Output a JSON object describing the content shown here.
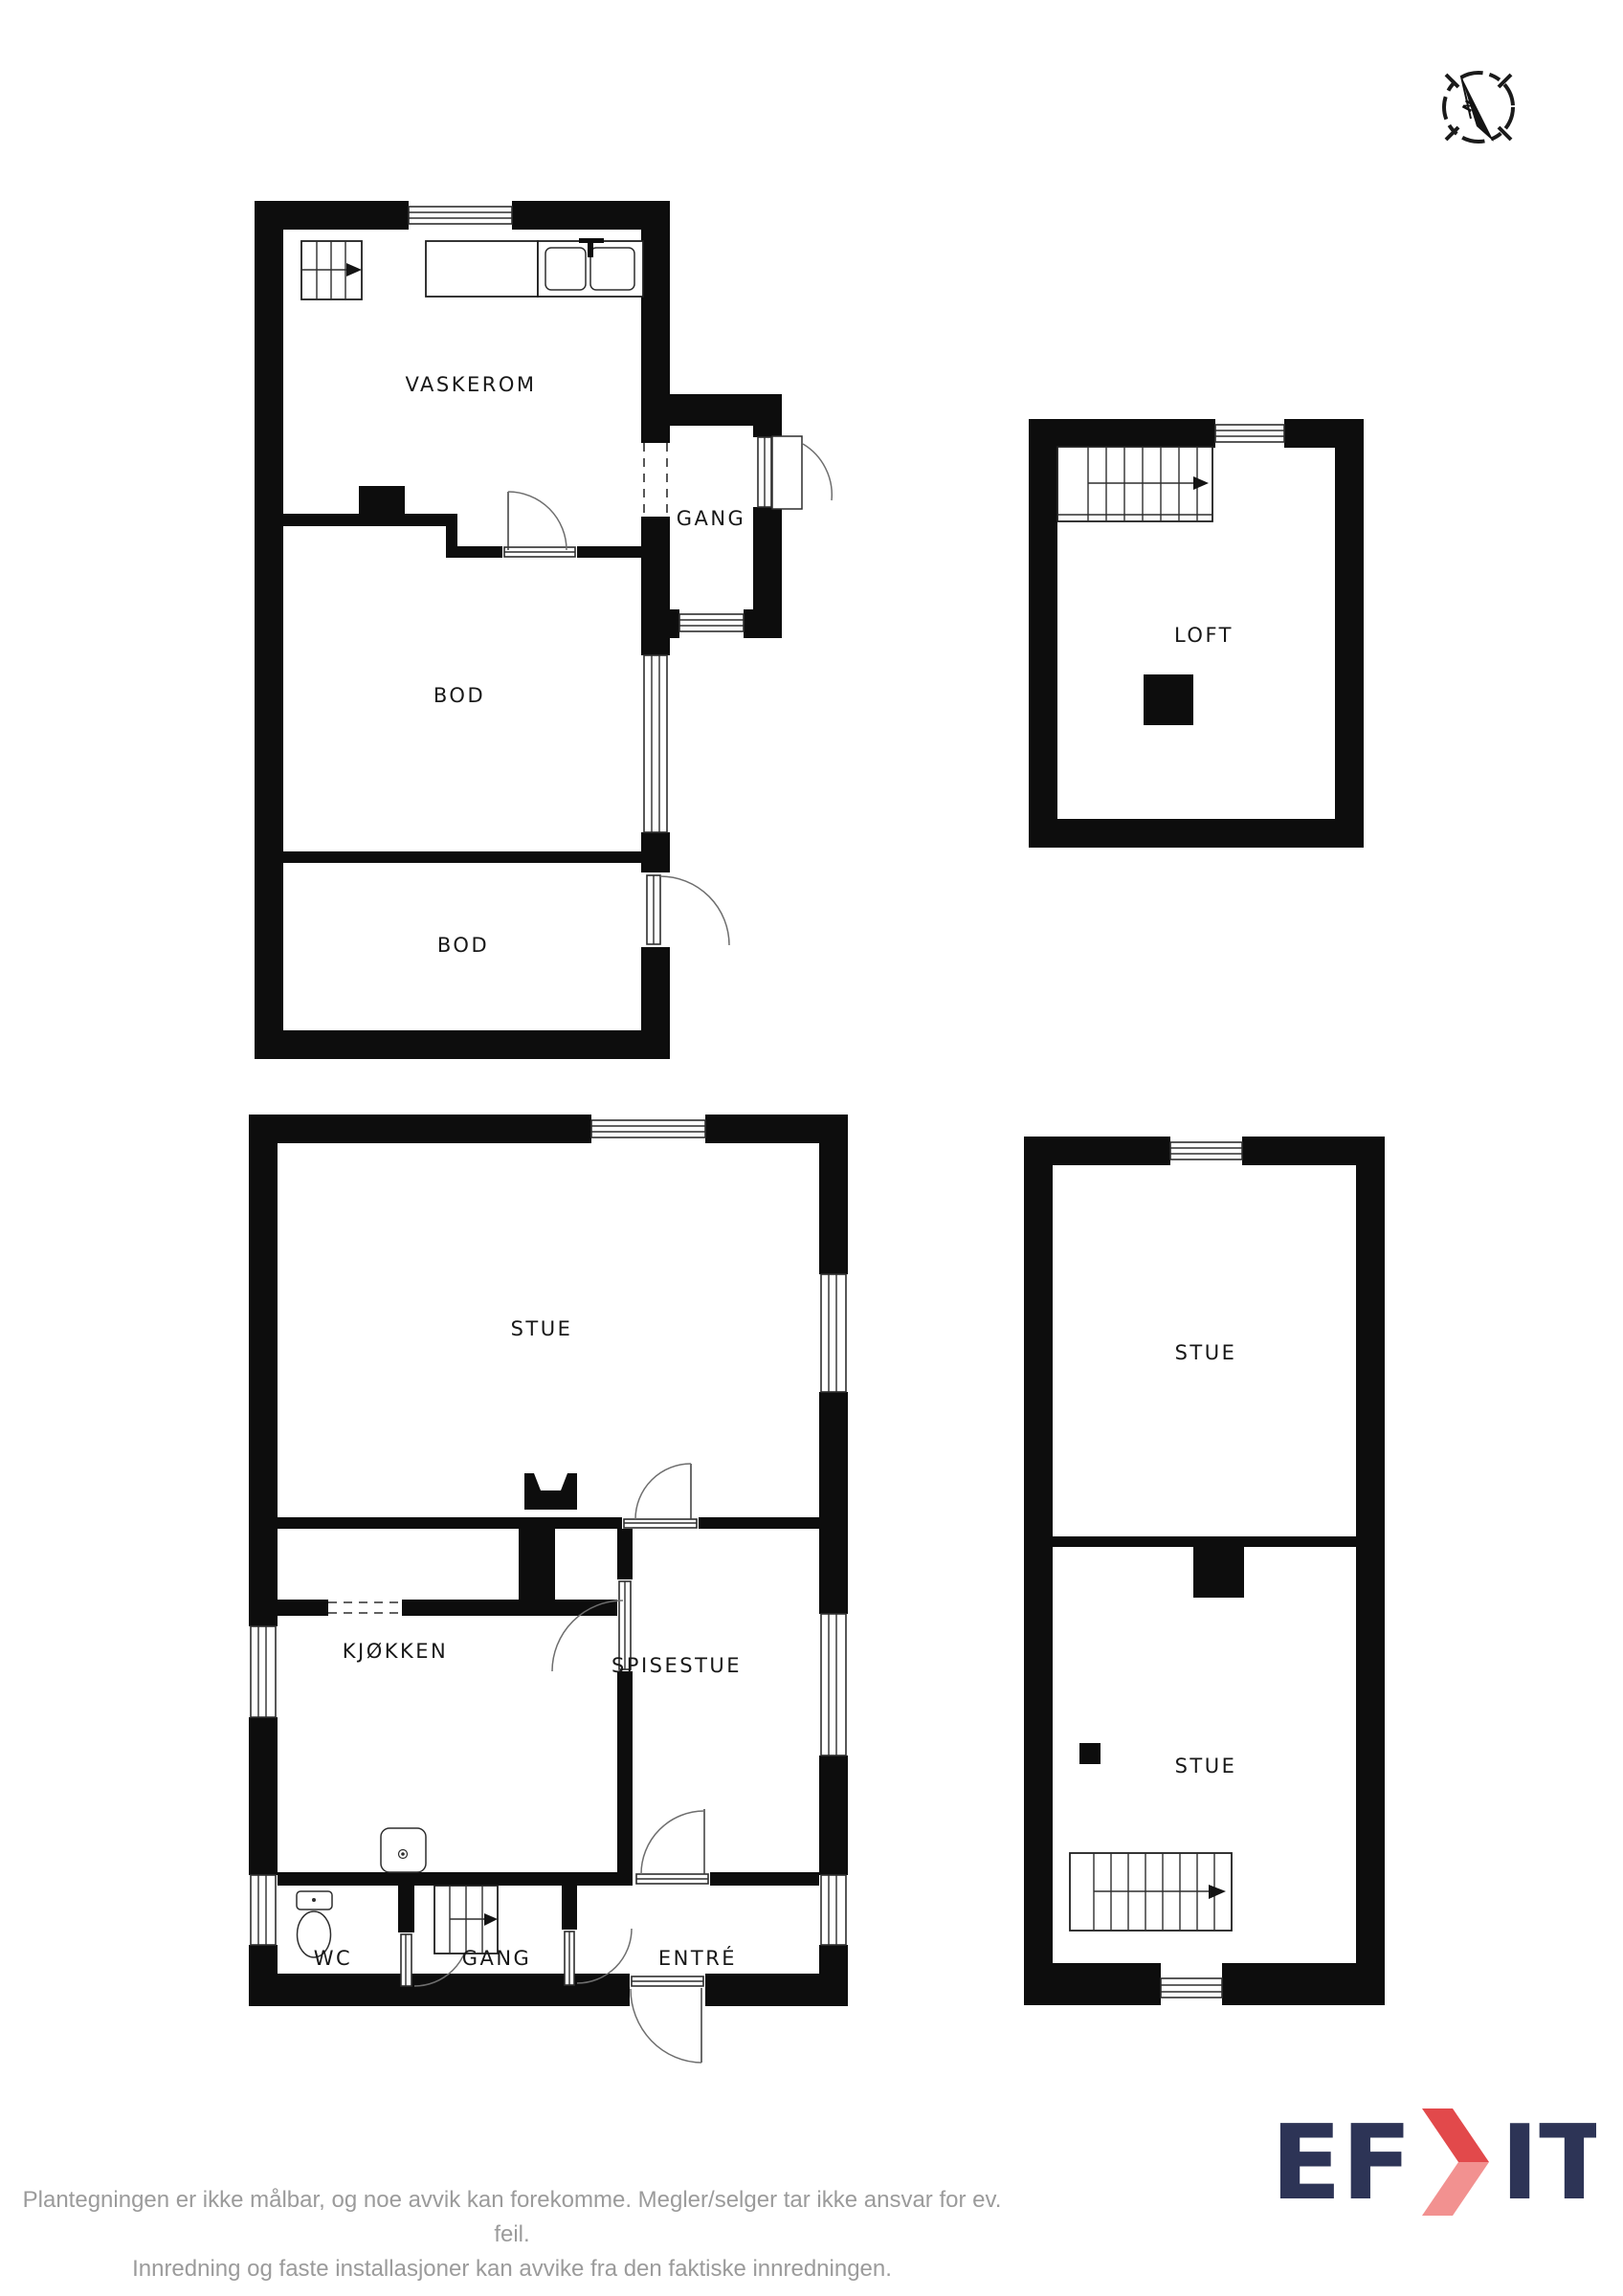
{
  "compass": {
    "north_label": "N"
  },
  "plans": {
    "basement": {
      "rooms": [
        {
          "label": "VASKEROM"
        },
        {
          "label": "GANG"
        },
        {
          "label": "BOD"
        },
        {
          "label": "BOD"
        }
      ]
    },
    "loft": {
      "rooms": [
        {
          "label": "LOFT"
        }
      ]
    },
    "main_floor": {
      "rooms": [
        {
          "label": "STUE"
        },
        {
          "label": "KJØKKEN"
        },
        {
          "label": "SPISESTUE"
        },
        {
          "label": "WC"
        },
        {
          "label": "GANG"
        },
        {
          "label": "ENTRÉ"
        }
      ]
    },
    "upper_floor": {
      "rooms": [
        {
          "label": "STUE"
        },
        {
          "label": "STUE"
        }
      ]
    }
  },
  "footer": {
    "line1": "Plantegningen er ikke målbar, og noe avvik kan forekomme. Megler/selger tar ikke ansvar for ev. feil.",
    "line2": "Innredning og faste installasjoner kan avvike fra den faktiske innredningen."
  },
  "logo": {
    "text_left": "EF",
    "text_right": "IT",
    "navy": "#2d3456",
    "red": "#e2494b",
    "red_light": "#f29190"
  },
  "colors": {
    "wall": "#0d0d0d",
    "footer_text": "#9b9b9b",
    "background": "#ffffff"
  }
}
